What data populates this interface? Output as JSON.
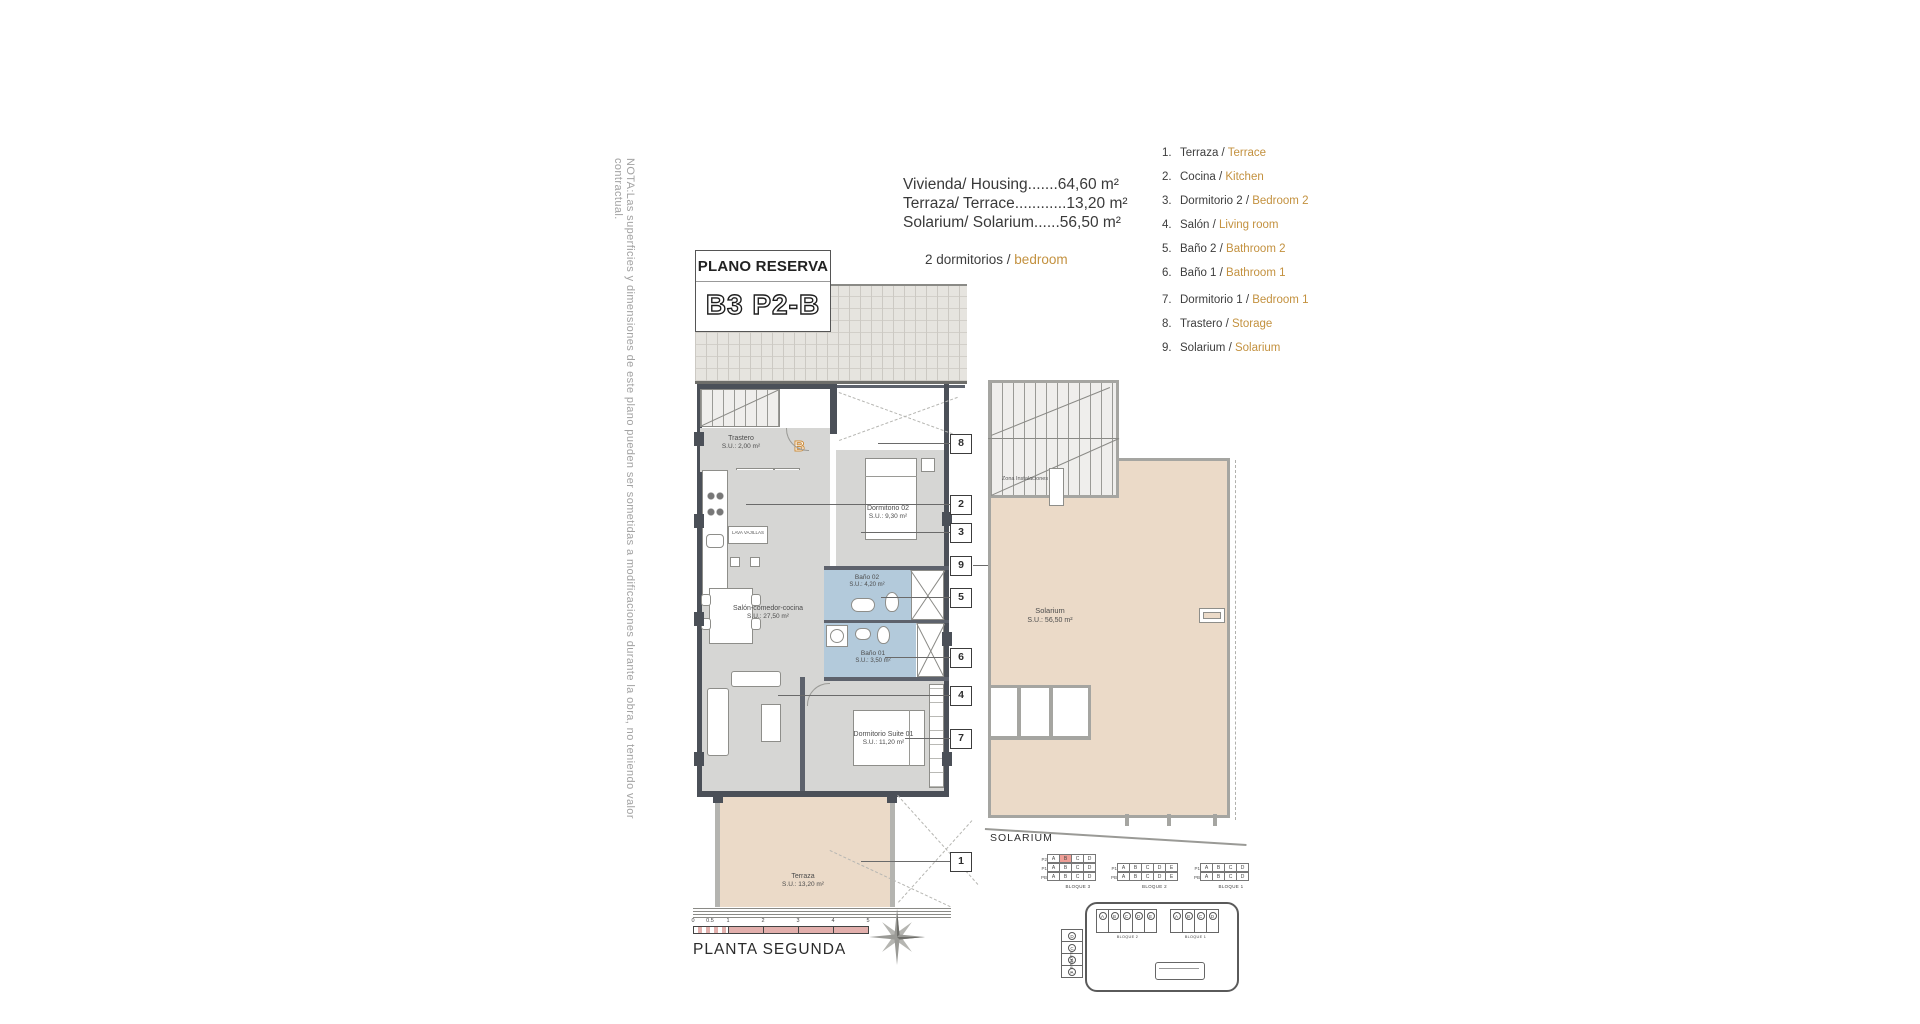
{
  "note": "NOTA:Las superficies y dimensiones de este plano pueden ser sometidas a modificaciones durante la obra, no teniendo valor contractual.",
  "title": {
    "main": "PLANO RESERVA",
    "unit": "B3 P2-B"
  },
  "areas": [
    "Vivienda/ Housing.......64,60 m²",
    "Terraza/ Terrace............13,20 m²",
    "Solarium/ Solarium......56,50 m²"
  ],
  "bedrooms": {
    "es": "2 dormitorios /",
    "en": "bedroom"
  },
  "legend": [
    {
      "n": "1.",
      "es": "Terraza / ",
      "en": "Terrace"
    },
    {
      "n": "2.",
      "es": "Cocina / ",
      "en": "Kitchen"
    },
    {
      "n": "3.",
      "es": "Dormitorio 2 / ",
      "en": "Bedroom 2"
    },
    {
      "n": "4.",
      "es": "Salón / ",
      "en": "Living room"
    },
    {
      "n": "5.",
      "es": "Baño 2 / ",
      "en": "Bathroom 2"
    },
    {
      "n": "6.",
      "es": "Baño 1 / ",
      "en": "Bathroom 1"
    },
    {
      "n": "7.",
      "es": "Dormitorio 1 / ",
      "en": "Bedroom 1"
    },
    {
      "n": "8.",
      "es": "Trastero / ",
      "en": "Storage"
    },
    {
      "n": "9.",
      "es": "Solarium / ",
      "en": "Solarium"
    }
  ],
  "rooms": {
    "trastero": {
      "name": "Trastero",
      "area": "S.U.: 2,00 m²"
    },
    "dorm02": {
      "name": "Dormitorio 02",
      "area": "S.U.: 9,30 m²"
    },
    "bano02": {
      "name": "Baño 02",
      "area": "S.U.: 4,20 m²"
    },
    "salon": {
      "name": "Salón-comedor-cocina",
      "area": "S.U.: 27,50 m²"
    },
    "bano01": {
      "name": "Baño 01",
      "area": "S.U.: 3,50 m²"
    },
    "suite": {
      "name": "Dormitorio Suite 01",
      "area": "S.U.: 11,20 m²"
    },
    "terraza": {
      "name": "Terraza",
      "area": "S.U.: 13,20 m²"
    }
  },
  "labels": {
    "horno": "HORNO MICRO",
    "frigo": "FRIGO",
    "lava": "LAVA VAJILLAS",
    "unit_letter": "B"
  },
  "callouts": [
    "8",
    "2",
    "3",
    "9",
    "5",
    "6",
    "4",
    "7",
    "1"
  ],
  "solarium": {
    "zona": "Zona Instalaciones",
    "name": "Solarium",
    "area": "S.U.: 56,50 m²",
    "caption": "SOLARIUM"
  },
  "footer": {
    "plant": "PLANTA SEGUNDA",
    "ticks": [
      "0",
      "0.5",
      "1",
      "2",
      "3",
      "4",
      "5"
    ]
  },
  "keyplan": {
    "blocks": [
      {
        "caption": "BLOQUE 3",
        "rows": [
          "P2",
          "P1",
          "PB"
        ],
        "cols": [
          "A",
          "B",
          "C",
          "D"
        ]
      },
      {
        "caption": "BLOQUE 2",
        "rows": [
          "P1",
          "PB"
        ],
        "cols": [
          "A",
          "B",
          "C",
          "D",
          "E"
        ]
      },
      {
        "caption": "BLOQUE 1",
        "rows": [
          "P1",
          "PB"
        ],
        "cols": [
          "A",
          "B",
          "C",
          "D"
        ]
      }
    ],
    "siteplan": {
      "b3": "BLOQUE 3",
      "b2": "BLOQUE 2",
      "b1": "BLOQUE 1",
      "b3_units": [
        "D",
        "C",
        "B",
        "A"
      ],
      "b2_units": [
        "A",
        "B",
        "C",
        "D",
        "E"
      ],
      "b1_units": [
        "A",
        "B",
        "C",
        "D"
      ]
    }
  },
  "colors": {
    "accent": "#c3913f",
    "wall": "#4b5058",
    "bath": "#b3cadb",
    "terrace": "#ebdac8",
    "highlight": "#ef9e96"
  }
}
